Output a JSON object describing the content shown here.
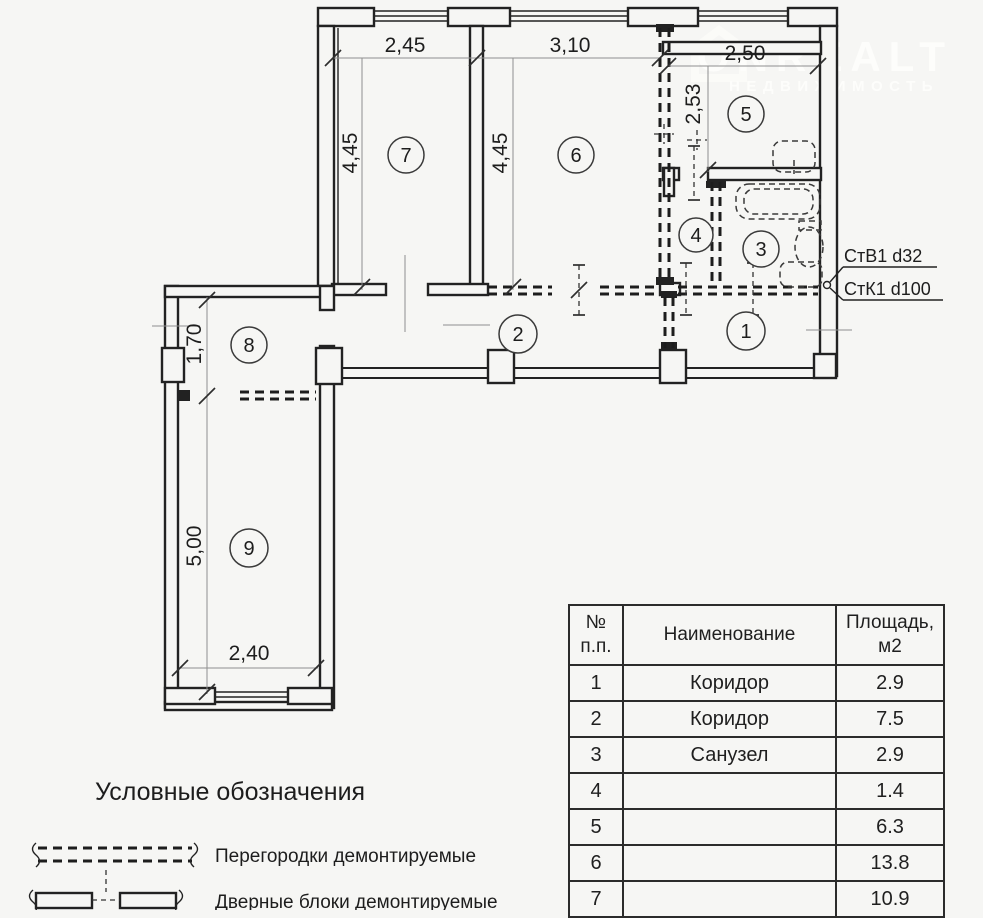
{
  "watermark": {
    "brand": "ONREALT",
    "subtitle": "НЕДВИЖИМОСТЬ"
  },
  "plan": {
    "rooms": {
      "r1": "1",
      "r2": "2",
      "r3": "3",
      "r4": "4",
      "r5": "5",
      "r6": "6",
      "r7": "7",
      "r8": "8",
      "r9": "9"
    },
    "dims": {
      "d245": "2,45",
      "d310": "3,10",
      "d250": "2,50",
      "d445a": "4,45",
      "d445b": "4,45",
      "d253": "2,53",
      "d170": "1,70",
      "d500": "5,00",
      "d240": "2,40"
    },
    "risers": {
      "stv": "СтВ1 d32",
      "stk": "СтК1 d100"
    }
  },
  "legend": {
    "title": "Условные обозначения",
    "item1": "Перегородки демонтируемые",
    "item2": "Дверные блоки демонтируемые"
  },
  "table": {
    "headers": [
      "№ п.п.",
      "Наименование",
      "Площадь, м2"
    ],
    "rows": [
      [
        "1",
        "Коридор",
        "2.9"
      ],
      [
        "2",
        "Коридор",
        "7.5"
      ],
      [
        "3",
        "Санузел",
        "2.9"
      ],
      [
        "4",
        "",
        "1.4"
      ],
      [
        "5",
        "",
        "6.3"
      ],
      [
        "6",
        "",
        "13.8"
      ],
      [
        "7",
        "",
        "10.9"
      ]
    ]
  }
}
